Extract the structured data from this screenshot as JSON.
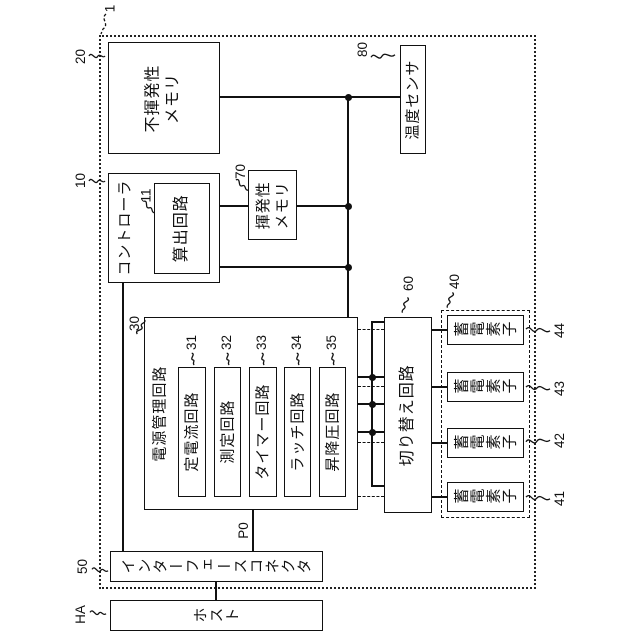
{
  "figure": {
    "refs": {
      "device": "1",
      "nvm": "20",
      "controller": "10",
      "calc": "11",
      "vm": "70",
      "temp": "80",
      "pm": "30",
      "cc": "31",
      "meas": "32",
      "timer": "33",
      "latch": "34",
      "updown": "35",
      "sw": "60",
      "cells_group": "40",
      "cell1": "41",
      "cell2": "42",
      "cell3": "43",
      "cell4": "44",
      "connector": "50",
      "host": "HA",
      "p0": "P0"
    },
    "blocks": {
      "nvm": "不揮発性\nメモリ",
      "controller": "コントローラ",
      "calc": "算出回路",
      "vm": "揮発性\nメモリ",
      "temp": "温度センサ",
      "pm": "電源管理回路",
      "cc": "定電流回路",
      "meas": "測定回路",
      "timer": "タイマー回路",
      "latch": "ラッチ回路",
      "updown": "昇降圧回路",
      "sw": "切り替え回路",
      "cell": "蓄電素子",
      "connector": "インターフェースコネクタ",
      "host": "ホスト"
    }
  }
}
